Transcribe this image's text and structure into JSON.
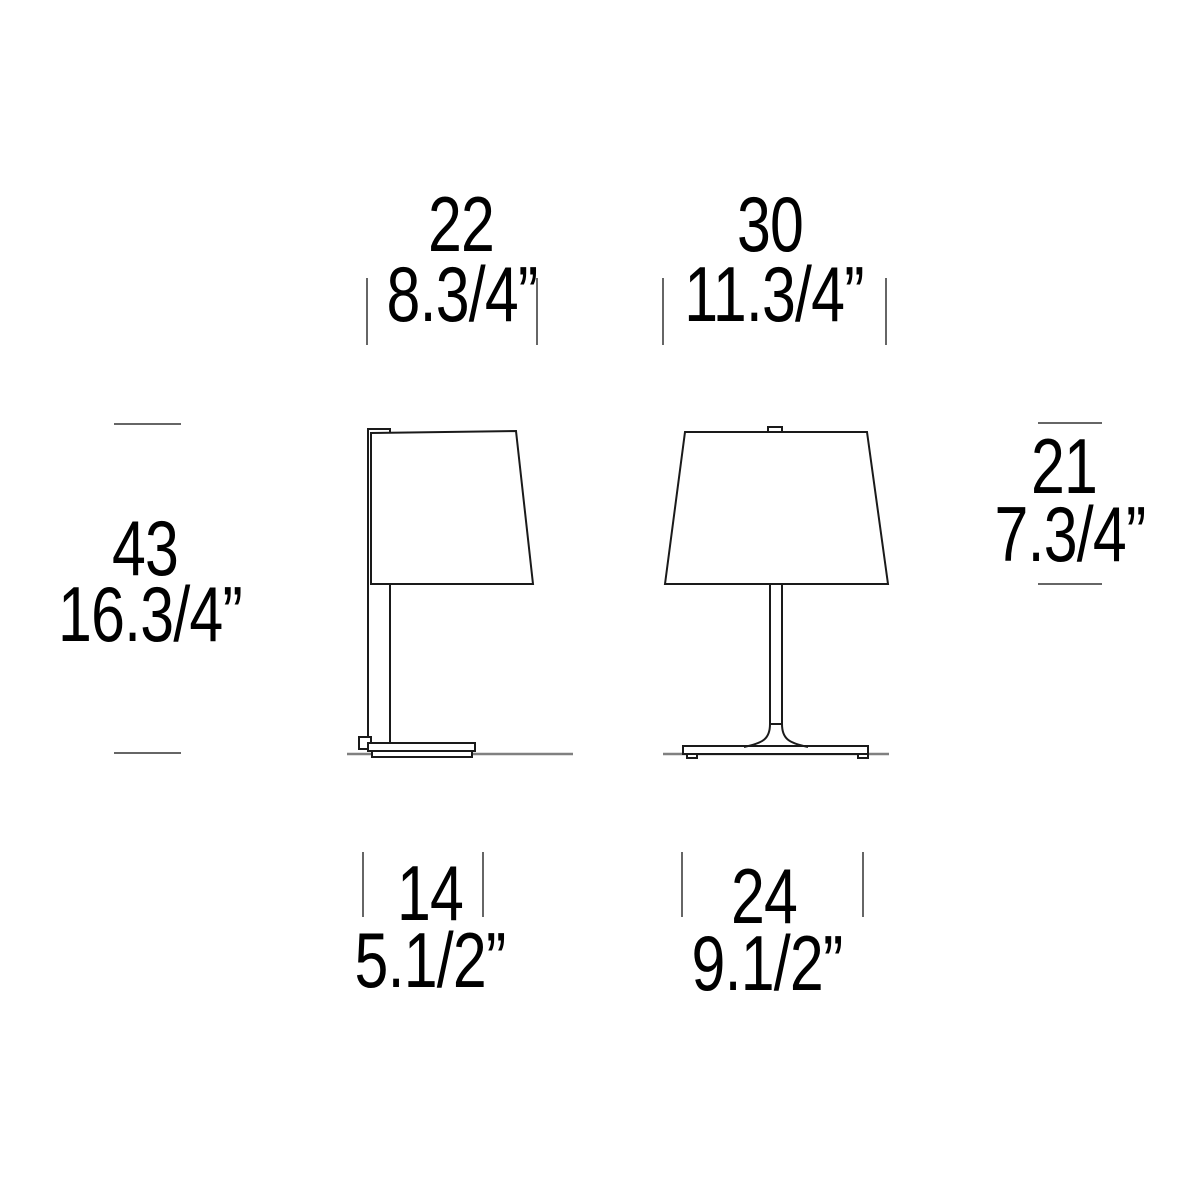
{
  "colors": {
    "line": "#1a1a1a",
    "tick": "#666666",
    "ground": "#808080",
    "text": "#000000",
    "bg": "#ffffff"
  },
  "diagram": {
    "type": "product-dimension-drawing",
    "subject": "two table lamps (side view and front view)"
  },
  "dimensions": {
    "lamp_small": {
      "shade_width": {
        "cm": "22",
        "inches": "8.3/4”"
      },
      "total_height": {
        "cm": "43",
        "inches": "16.3/4”"
      },
      "base_width": {
        "cm": "14",
        "inches": "5.1/2”"
      }
    },
    "lamp_large": {
      "shade_width": {
        "cm": "30",
        "inches": "11.3/4”"
      },
      "shade_height": {
        "cm": "21",
        "inches": "7.3/4”"
      },
      "base_width": {
        "cm": "24",
        "inches": "9.1/2”"
      }
    }
  }
}
